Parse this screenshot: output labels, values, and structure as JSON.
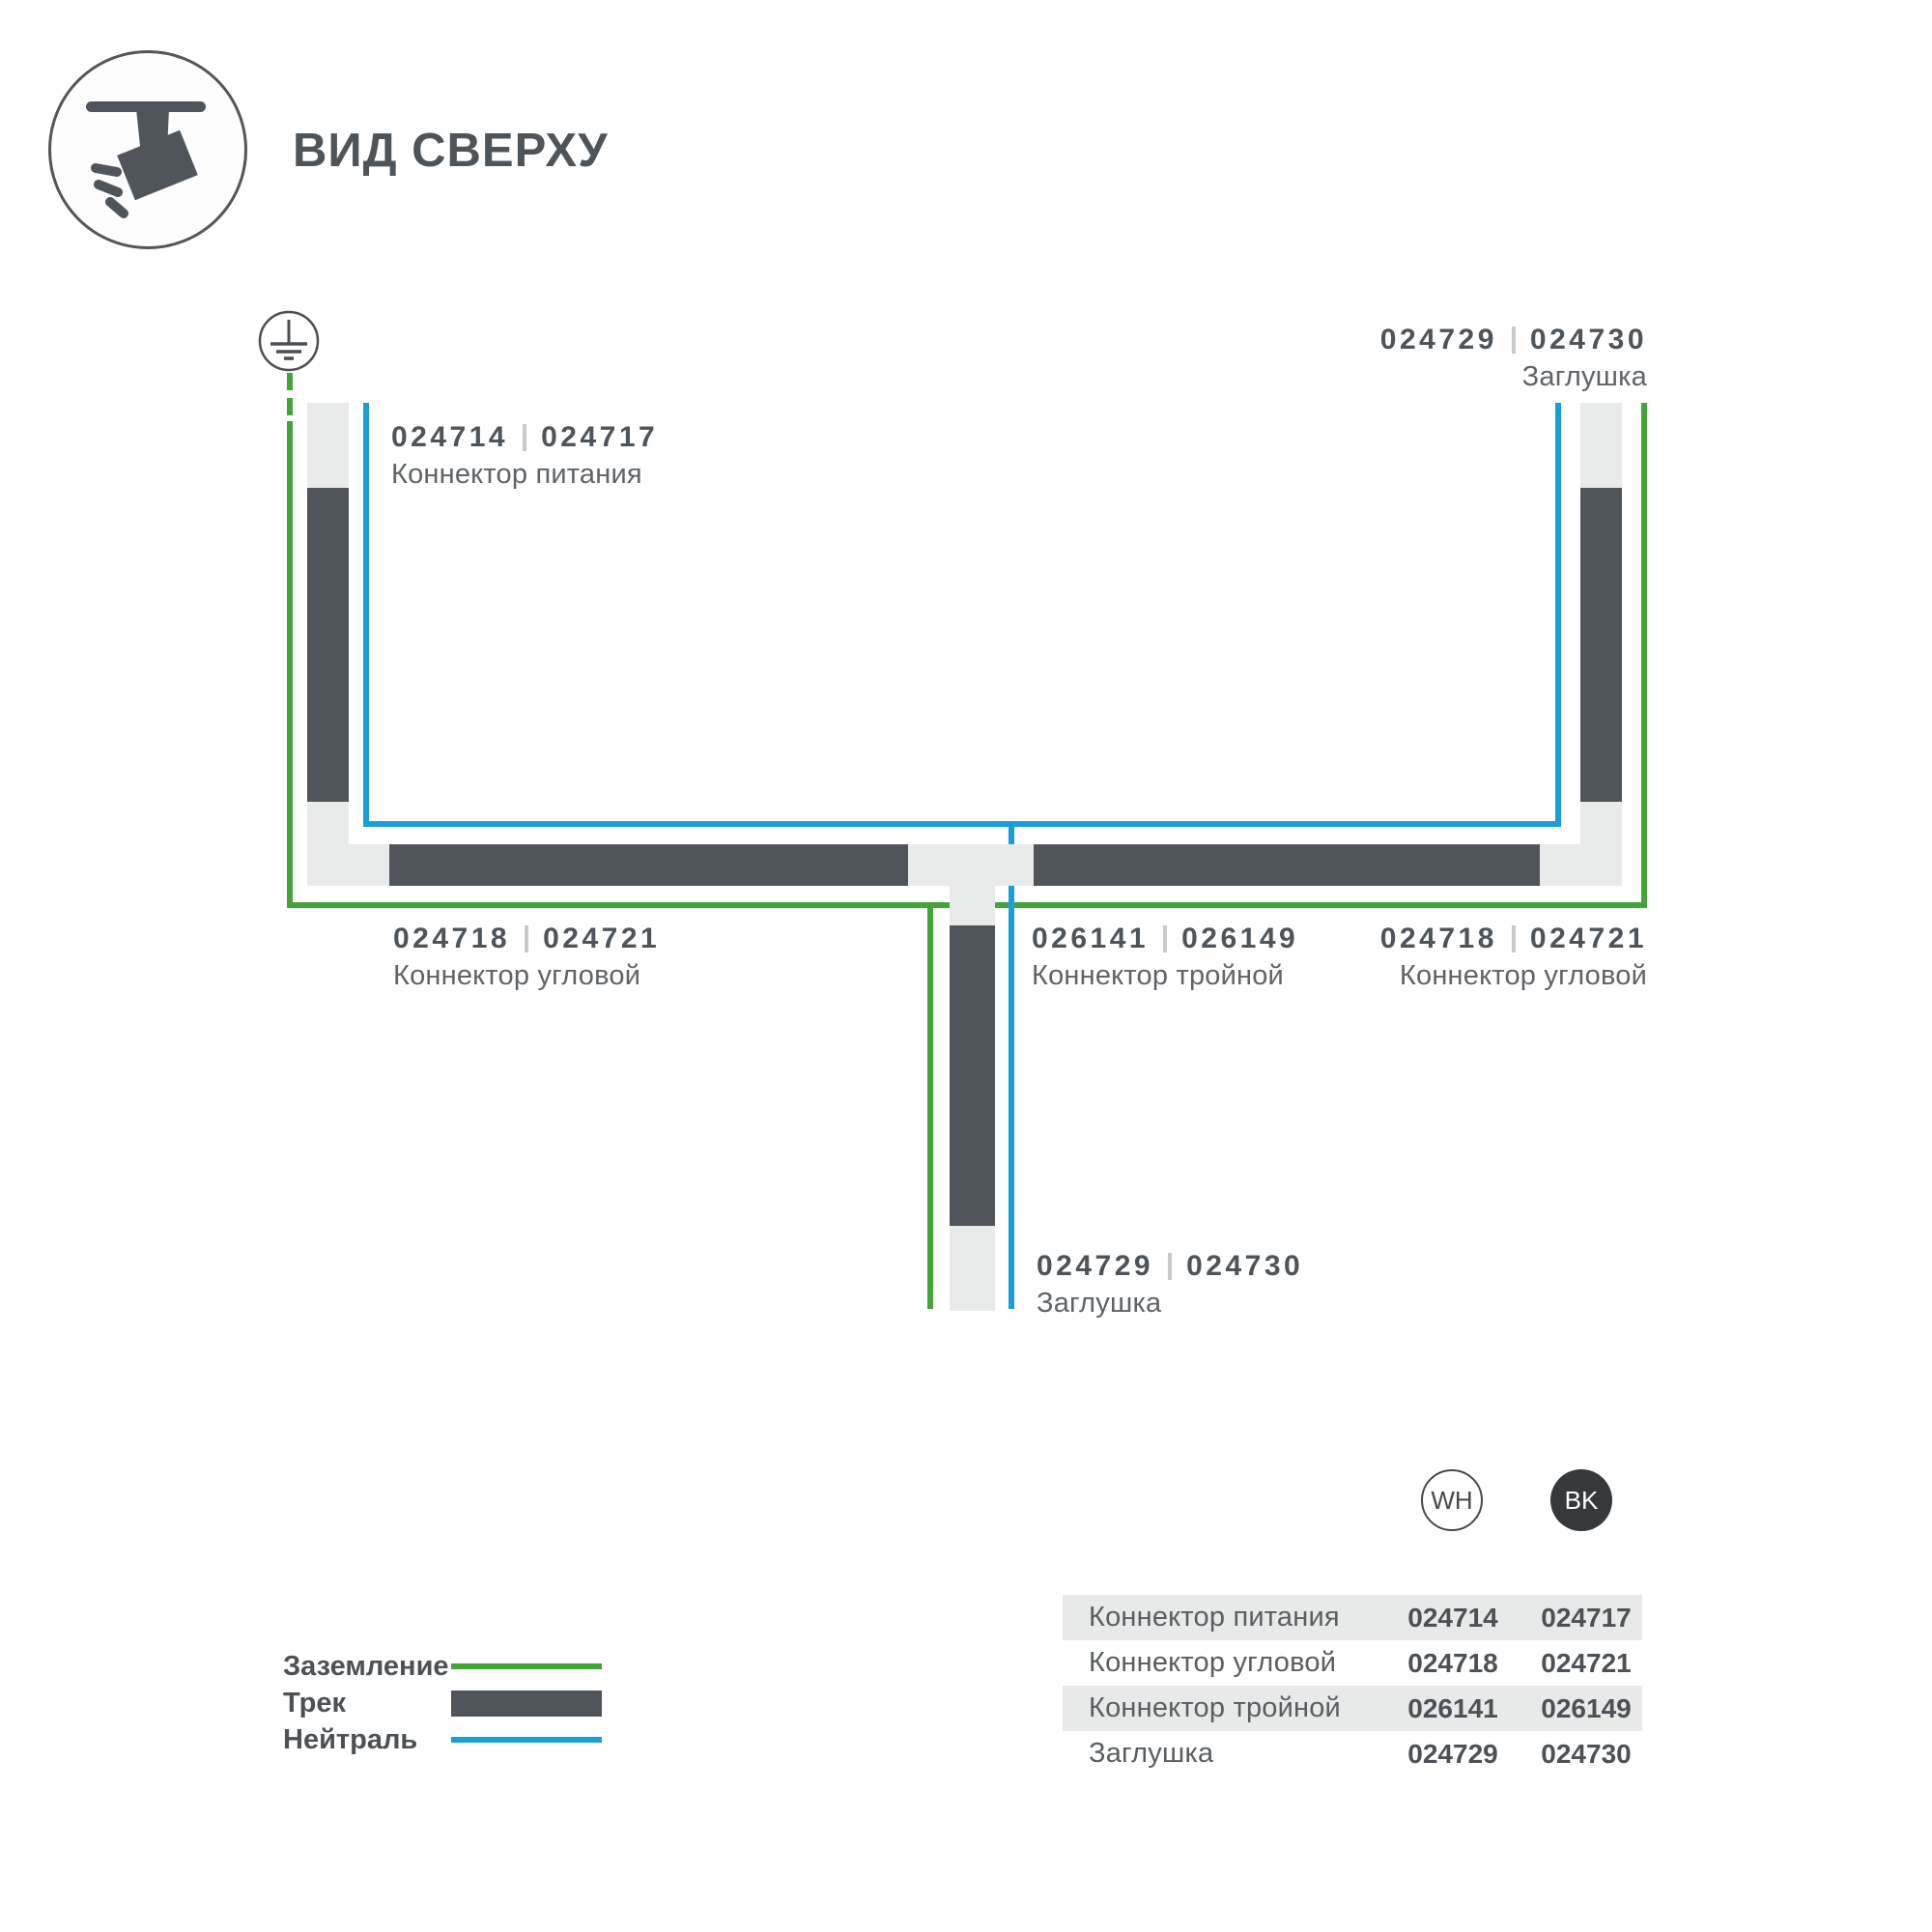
{
  "title": "ВИД СВЕРХУ",
  "colors": {
    "ground_green": "#41a538",
    "neutral_blue": "#189fd9",
    "track_dark": "#4f555b",
    "track_light": "#e9ebeb",
    "text_dark": "#4d545a",
    "text_gray": "#5f6468"
  },
  "diagram": {
    "labels": [
      {
        "codes": [
          "024714",
          "024717"
        ],
        "name": "Коннектор питания"
      },
      {
        "codes": [
          "024729",
          "024730"
        ],
        "name": "Заглушка"
      },
      {
        "codes": [
          "024718",
          "024721"
        ],
        "name": "Коннектор угловой"
      },
      {
        "codes": [
          "026141",
          "026149"
        ],
        "name": "Коннектор тройной"
      },
      {
        "codes": [
          "024718",
          "024721"
        ],
        "name": "Коннектор угловой"
      },
      {
        "codes": [
          "024729",
          "024730"
        ],
        "name": "Заглушка"
      }
    ]
  },
  "legend": {
    "ground": "Заземление",
    "track": "Трек",
    "neutral": "Нейтраль"
  },
  "variants": [
    {
      "code": "WH"
    },
    {
      "code": "BK"
    }
  ],
  "table": {
    "rows": [
      {
        "name": "Коннектор питания",
        "wh": "024714",
        "bk": "024717"
      },
      {
        "name": "Коннектор угловой",
        "wh": "024718",
        "bk": "024721"
      },
      {
        "name": "Коннектор тройной",
        "wh": "026141",
        "bk": "026149"
      },
      {
        "name": "Заглушка",
        "wh": "024729",
        "bk": "024730"
      }
    ]
  }
}
